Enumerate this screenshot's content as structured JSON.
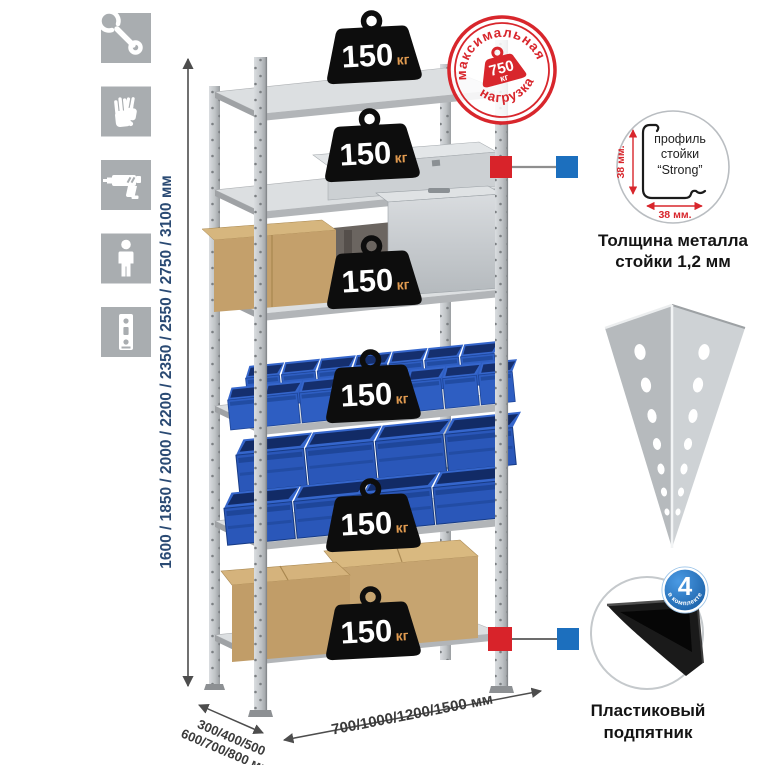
{
  "page": {
    "background": "#ffffff"
  },
  "colors": {
    "accent_red": "#d8232a",
    "accent_blue": "#1c6fbe",
    "icon_gray": "#a9adb0",
    "dimension_navy": "#2a4a73",
    "kg_orange": "#e09a50"
  },
  "left_icons": [
    {
      "name": "wrench"
    },
    {
      "name": "gloves"
    },
    {
      "name": "drill"
    },
    {
      "name": "person"
    },
    {
      "name": "post-strip"
    }
  ],
  "height_dimension": {
    "label": "1600 / 1850 / 2000 / 2200 / 2350 / 2550 / 2750 / 3100 мм"
  },
  "depth_dimension": {
    "line1": "300/400/500",
    "line2": "600/700/800 мм"
  },
  "width_dimension": {
    "label": "700/1000/1200/1500 мм"
  },
  "shelf_load": {
    "value": "150",
    "unit": "кг"
  },
  "max_load_stamp": {
    "arc_top": "максимальная",
    "arc_bottom": "нагрузка",
    "value": "750",
    "unit": "кг"
  },
  "profile_callout": {
    "label_line1": "профиль",
    "label_line2": "стойки",
    "label_line3": "“Strong”",
    "dim_vertical": "38 мм.",
    "dim_horizontal": "38 мм.",
    "caption_line1": "Толщина металла",
    "caption_line2": "стойки 1,2 мм"
  },
  "foot_callout": {
    "badge_value": "4",
    "badge_text": "в комплекте",
    "caption_line1": "Пластиковый",
    "caption_line2": "подпятник"
  }
}
